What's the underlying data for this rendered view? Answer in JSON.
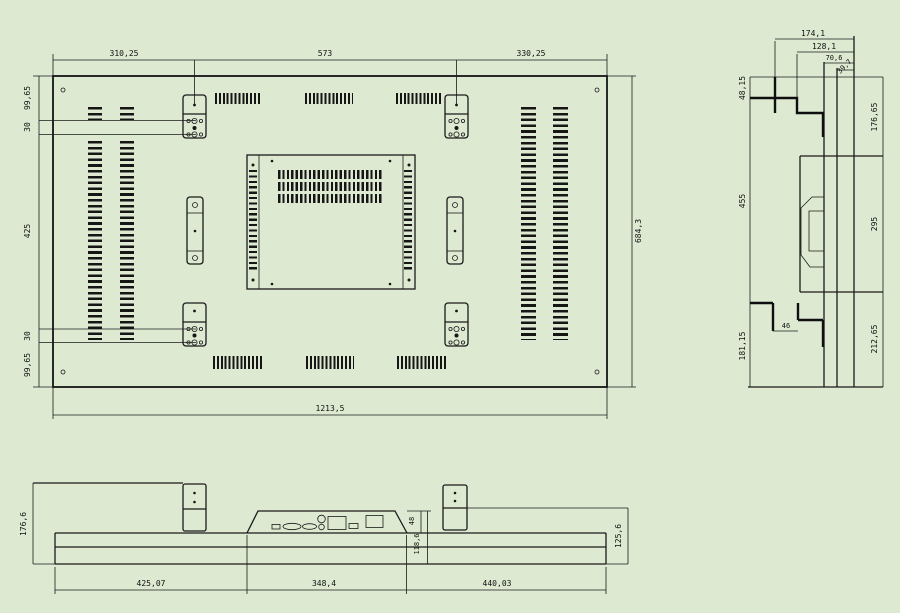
{
  "drawing_title": "display-panel-mechanical-drawing",
  "colors": {
    "background": "#dee9d2",
    "line": "#1a1a1a"
  },
  "rear": {
    "top_left": "310,25",
    "top_center": "573",
    "top_right": "330,25",
    "left_top_margin": "99,65",
    "left_gap_top": "30",
    "left_middle": "425",
    "left_gap_bottom": "30",
    "left_bottom_margin": "99,65",
    "right_height": "684,3",
    "bottom_width": "1213,5"
  },
  "side": {
    "depth_1": "174,1",
    "depth_2": "128,1",
    "depth_3": "70,6",
    "depth_4": "39,7",
    "left_top": "48,15",
    "left_mid": "455",
    "left_bottom": "181,15",
    "right_top": "176,65",
    "right_mid": "295",
    "right_bottom": "212,65",
    "bracket_width": "46"
  },
  "bottom": {
    "height_left": "176,6",
    "seg_left": "425,07",
    "seg_center": "348,4",
    "seg_right": "440,03",
    "conn_height": "48",
    "body_height": "118,6",
    "height_right": "125,6"
  }
}
